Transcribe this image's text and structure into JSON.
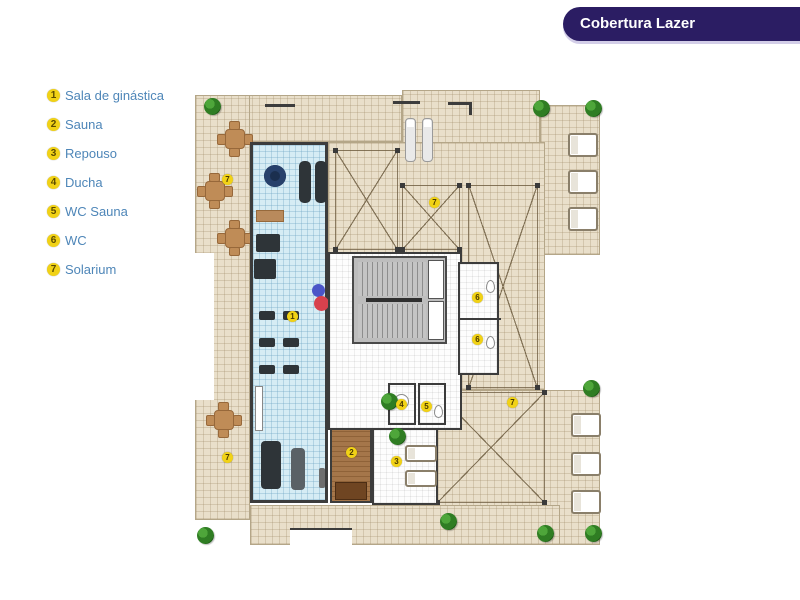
{
  "banner": {
    "title": "Cobertura Lazer"
  },
  "legend": {
    "items": [
      {
        "num": "1",
        "label": "Sala de ginástica"
      },
      {
        "num": "2",
        "label": "Sauna"
      },
      {
        "num": "3",
        "label": "Repouso"
      },
      {
        "num": "4",
        "label": "Ducha"
      },
      {
        "num": "5",
        "label": "WC Sauna"
      },
      {
        "num": "6",
        "label": "WC"
      },
      {
        "num": "7",
        "label": "Solarium"
      }
    ]
  },
  "plan": {
    "markers": [
      {
        "num": "1",
        "label": "Sala de ginástica",
        "x": 97,
        "y": 231
      },
      {
        "num": "2",
        "label": "Sauna",
        "x": 156,
        "y": 367
      },
      {
        "num": "3",
        "label": "Repouso",
        "x": 201,
        "y": 376
      },
      {
        "num": "4",
        "label": "Ducha",
        "x": 206,
        "y": 319
      },
      {
        "num": "5",
        "label": "WC Sauna",
        "x": 231,
        "y": 321
      },
      {
        "num": "6",
        "label": "WC",
        "x": 282,
        "y": 212
      },
      {
        "num": "6",
        "label": "WC",
        "x": 282,
        "y": 254
      },
      {
        "num": "7",
        "label": "Solarium",
        "x": 32,
        "y": 94
      },
      {
        "num": "7",
        "label": "Solarium",
        "x": 32,
        "y": 372
      },
      {
        "num": "7",
        "label": "Solarium",
        "x": 239,
        "y": 117
      },
      {
        "num": "7",
        "label": "Solarium",
        "x": 317,
        "y": 317
      }
    ],
    "colors": {
      "banner_bg": "#2b1d63",
      "legend_text": "#4e86b8",
      "badge_yellow": "#f1d216",
      "terrace_tile": "#e9dfca",
      "gym_floor": "#d6ecf4",
      "sauna_wood": "#a5764a",
      "ball_blue": "#4b55c8",
      "ball_red": "#d8414d",
      "plant_green": "#2f7d23"
    }
  }
}
